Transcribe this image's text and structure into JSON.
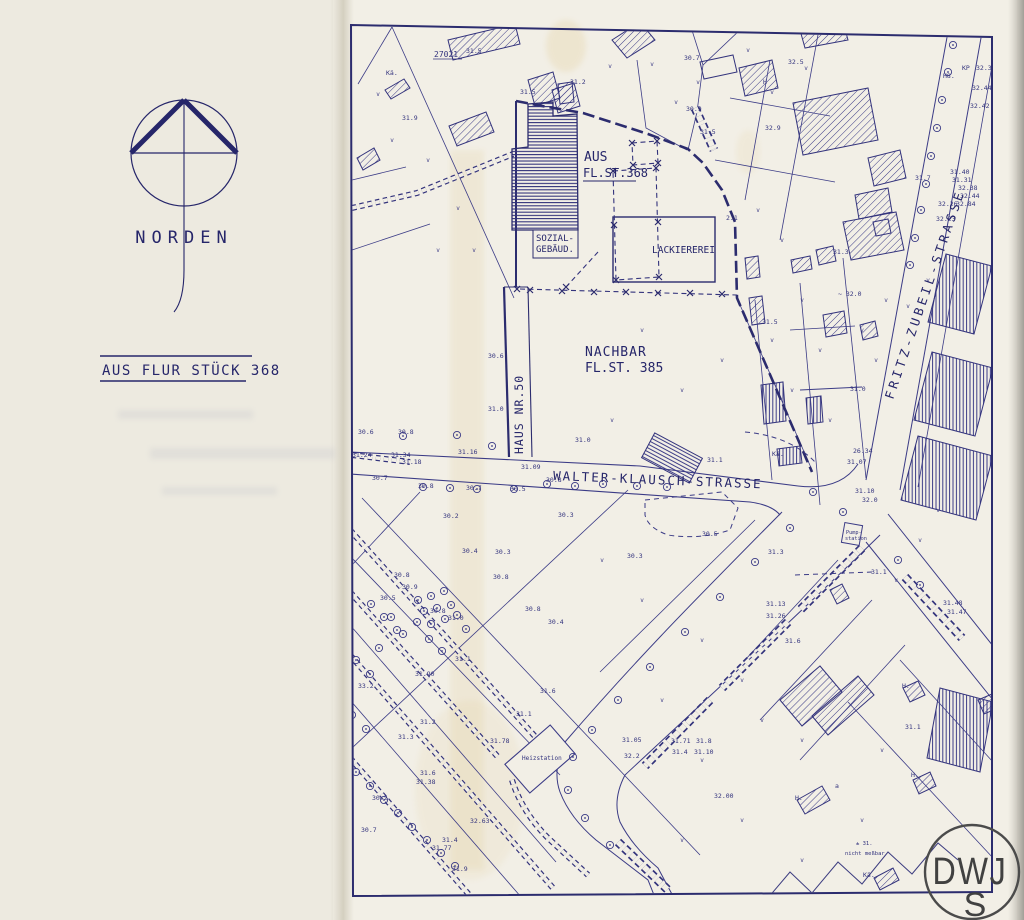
{
  "colors": {
    "ink": "#3b3b86",
    "ink_bold": "#2c2c6e",
    "paper": "#f2efe6",
    "margin_paper": "#edeae0",
    "stamp_ink": "#4b4b4b"
  },
  "margin": {
    "norden_label": "NORDEN",
    "flur_note": "AUS FLUR STÜCK 368"
  },
  "map": {
    "labels": {
      "parcel_no": "27021",
      "aus_line1": "AUS",
      "aus_line2": "FL.ST.368",
      "sozial_line1": "SOZIAL-",
      "sozial_line2": "GEBÄUD.",
      "lackiererei": "LACKIEREREI",
      "nachbar_line1": "NACHBAR",
      "nachbar_line2": "FL.ST. 385",
      "haus_nr": "HAUS NR.50",
      "walter_strasse": "WALTER-KLAUSCH-STRASSE",
      "fritz_strasse": "FRITZ-ZUBEIL-STRASSE",
      "heizstation": "Heizstation",
      "pump_line1": "Pump-",
      "pump_line2": "station",
      "nicht_line1": "± 31.",
      "nicht_line2": "nicht meßbar"
    },
    "stamp": {
      "line1": "DWJ",
      "line2": "S"
    },
    "numbers": [
      {
        "t": "31.5",
        "x": 466,
        "y": 53
      },
      {
        "t": "31.9",
        "x": 402,
        "y": 120
      },
      {
        "t": "31.5",
        "x": 520,
        "y": 94
      },
      {
        "t": "31.2",
        "x": 570,
        "y": 84
      },
      {
        "t": "30.7",
        "x": 684,
        "y": 60
      },
      {
        "t": "30.9",
        "x": 686,
        "y": 111
      },
      {
        "t": "32.5",
        "x": 788,
        "y": 64
      },
      {
        "t": "32.9",
        "x": 765,
        "y": 130
      },
      {
        "t": "31.7",
        "x": 915,
        "y": 180
      },
      {
        "t": "H8.",
        "x": 943,
        "y": 78
      },
      {
        "t": "KP",
        "x": 962,
        "y": 70
      },
      {
        "t": "31.74",
        "x": 955,
        "y": 33
      },
      {
        "t": "30.76",
        "x": 974,
        "y": 31
      },
      {
        "t": "32.34",
        "x": 976,
        "y": 70
      },
      {
        "t": "32.44",
        "x": 972,
        "y": 90
      },
      {
        "t": "32.42",
        "x": 970,
        "y": 108
      },
      {
        "t": "31.40",
        "x": 950,
        "y": 174
      },
      {
        "t": "31.31",
        "x": 952,
        "y": 182
      },
      {
        "t": "32.38",
        "x": 958,
        "y": 190
      },
      {
        "t": "32.44",
        "x": 960,
        "y": 198
      },
      {
        "t": "32.84",
        "x": 956,
        "y": 206
      },
      {
        "t": "32.26",
        "x": 938,
        "y": 206
      },
      {
        "t": "32.23",
        "x": 936,
        "y": 221
      },
      {
        "t": "2.1",
        "x": 726,
        "y": 220
      },
      {
        "t": "31.3",
        "x": 833,
        "y": 254
      },
      {
        "t": "~ 32.0",
        "x": 838,
        "y": 296
      },
      {
        "t": "31.5",
        "x": 762,
        "y": 324
      },
      {
        "t": "31.0",
        "x": 850,
        "y": 391
      },
      {
        "t": "26.34",
        "x": 853,
        "y": 453
      },
      {
        "t": "31.07",
        "x": 847,
        "y": 464
      },
      {
        "t": "31.10",
        "x": 855,
        "y": 493
      },
      {
        "t": "32.0",
        "x": 862,
        "y": 502
      },
      {
        "t": "30.6",
        "x": 488,
        "y": 358
      },
      {
        "t": "31.0",
        "x": 488,
        "y": 411
      },
      {
        "t": "31.0",
        "x": 575,
        "y": 442
      },
      {
        "t": "31.1",
        "x": 707,
        "y": 462
      },
      {
        "t": "30.6",
        "x": 358,
        "y": 434
      },
      {
        "t": "30.8",
        "x": 398,
        "y": 434
      },
      {
        "t": "31.24",
        "x": 352,
        "y": 457
      },
      {
        "t": "31.34",
        "x": 391,
        "y": 457
      },
      {
        "t": "31.18",
        "x": 402,
        "y": 464
      },
      {
        "t": "31.16",
        "x": 458,
        "y": 454
      },
      {
        "t": "31.09",
        "x": 521,
        "y": 469
      },
      {
        "t": "30.8",
        "x": 546,
        "y": 482
      },
      {
        "t": "30.7",
        "x": 372,
        "y": 480
      },
      {
        "t": "30.8",
        "x": 418,
        "y": 488
      },
      {
        "t": "30.7",
        "x": 466,
        "y": 490
      },
      {
        "t": "30.5",
        "x": 510,
        "y": 491
      },
      {
        "t": "30.2",
        "x": 443,
        "y": 518
      },
      {
        "t": "30.3",
        "x": 558,
        "y": 517
      },
      {
        "t": "30.5",
        "x": 702,
        "y": 536
      },
      {
        "t": "30.3",
        "x": 627,
        "y": 558
      },
      {
        "t": "30.4",
        "x": 462,
        "y": 553
      },
      {
        "t": "30.3",
        "x": 495,
        "y": 554
      },
      {
        "t": "30.8",
        "x": 394,
        "y": 577
      },
      {
        "t": "30.9",
        "x": 402,
        "y": 589
      },
      {
        "t": "30.5",
        "x": 380,
        "y": 600
      },
      {
        "t": "30.8",
        "x": 430,
        "y": 613
      },
      {
        "t": "31.0",
        "x": 448,
        "y": 620
      },
      {
        "t": "30.8",
        "x": 493,
        "y": 579
      },
      {
        "t": "30.8",
        "x": 525,
        "y": 611
      },
      {
        "t": "30.4",
        "x": 548,
        "y": 624
      },
      {
        "t": "31.3",
        "x": 768,
        "y": 554
      },
      {
        "t": "31.1",
        "x": 871,
        "y": 574
      },
      {
        "t": "31.6",
        "x": 785,
        "y": 643
      },
      {
        "t": "31.48",
        "x": 943,
        "y": 605
      },
      {
        "t": "31.47",
        "x": 947,
        "y": 614
      },
      {
        "t": "31.13",
        "x": 766,
        "y": 606
      },
      {
        "t": "31.26",
        "x": 766,
        "y": 618
      },
      {
        "t": "31.1",
        "x": 905,
        "y": 729
      },
      {
        "t": "33.2",
        "x": 358,
        "y": 688
      },
      {
        "t": "31.1",
        "x": 455,
        "y": 661
      },
      {
        "t": "31.90",
        "x": 415,
        "y": 676
      },
      {
        "t": "31.6",
        "x": 540,
        "y": 693
      },
      {
        "t": "31.2",
        "x": 420,
        "y": 724
      },
      {
        "t": "31.3",
        "x": 398,
        "y": 739
      },
      {
        "t": "31.78",
        "x": 490,
        "y": 743
      },
      {
        "t": "31.1",
        "x": 516,
        "y": 716
      },
      {
        "t": "31.05",
        "x": 622,
        "y": 742
      },
      {
        "t": "32.2",
        "x": 624,
        "y": 758
      },
      {
        "t": "31.71",
        "x": 671,
        "y": 743
      },
      {
        "t": "31.4",
        "x": 672,
        "y": 754
      },
      {
        "t": "31.8",
        "x": 696,
        "y": 743
      },
      {
        "t": "31.10",
        "x": 694,
        "y": 754
      },
      {
        "t": "32.00",
        "x": 714,
        "y": 798
      },
      {
        "t": "31.6",
        "x": 420,
        "y": 775
      },
      {
        "t": "31.38",
        "x": 416,
        "y": 784
      },
      {
        "t": "30.2",
        "x": 372,
        "y": 800
      },
      {
        "t": "30.7",
        "x": 361,
        "y": 832
      },
      {
        "t": "32.63",
        "x": 470,
        "y": 823
      },
      {
        "t": "31.4",
        "x": 442,
        "y": 842
      },
      {
        "t": "31.77",
        "x": 432,
        "y": 850
      },
      {
        "t": "31.9",
        "x": 452,
        "y": 871
      },
      {
        "t": "a",
        "x": 835,
        "y": 788
      },
      {
        "t": "Kä.",
        "x": 863,
        "y": 877
      },
      {
        "t": "H.",
        "x": 902,
        "y": 688
      },
      {
        "t": "H.",
        "x": 911,
        "y": 777
      },
      {
        "t": "H.",
        "x": 795,
        "y": 800
      },
      {
        "t": "Kä.",
        "x": 772,
        "y": 456
      },
      {
        "t": "Kä.",
        "x": 386,
        "y": 75
      },
      {
        "t": "H",
        "x": 763,
        "y": 84
      },
      {
        "t": "31.5",
        "x": 700,
        "y": 134
      }
    ]
  }
}
